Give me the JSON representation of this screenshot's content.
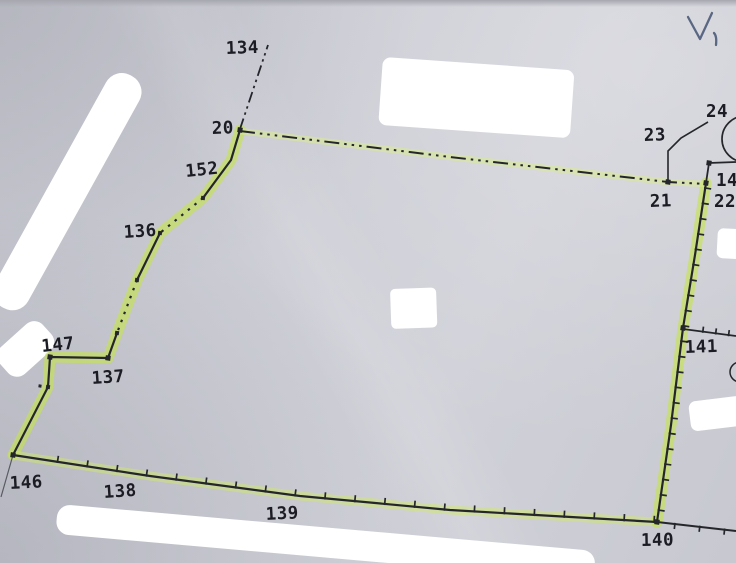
{
  "canvas": {
    "width": 736,
    "height": 563
  },
  "palette": {
    "paper": "#cbccd4",
    "ink": "#24262b",
    "label": "#1b1c24",
    "whiteout": "#ffffff",
    "highlight_bright": "#c7e34c",
    "highlight_pale": "#d9eb90",
    "handwriting_ink": "#5a6783"
  },
  "map": {
    "point_labels": [
      {
        "id": "134",
        "text": "134",
        "x": 226,
        "y": 54,
        "rot": -2
      },
      {
        "id": "20",
        "text": "20",
        "x": 212,
        "y": 134,
        "rot": -2
      },
      {
        "id": "152",
        "text": "152",
        "x": 186,
        "y": 177,
        "rot": -6
      },
      {
        "id": "136",
        "text": "136",
        "x": 124,
        "y": 238,
        "rot": -4
      },
      {
        "id": "147",
        "text": "147",
        "x": 42,
        "y": 352,
        "rot": -6
      },
      {
        "id": "137",
        "text": "137",
        "x": 92,
        "y": 384,
        "rot": -4
      },
      {
        "id": "146",
        "text": "146",
        "x": 10,
        "y": 489,
        "rot": -3
      },
      {
        "id": "138",
        "text": "138",
        "x": 104,
        "y": 498,
        "rot": -4
      },
      {
        "id": "139",
        "text": "139",
        "x": 266,
        "y": 520,
        "rot": -3
      },
      {
        "id": "140",
        "text": "140",
        "x": 641,
        "y": 546,
        "rot": -1
      },
      {
        "id": "141",
        "text": "141",
        "x": 685,
        "y": 353,
        "rot": -2
      },
      {
        "id": "21",
        "text": "21",
        "x": 650,
        "y": 207,
        "rot": -2
      },
      {
        "id": "22",
        "text": "22",
        "x": 714,
        "y": 207,
        "rot": 0
      },
      {
        "id": "23",
        "text": "23",
        "x": 644,
        "y": 141,
        "rot": -2
      },
      {
        "id": "24",
        "text": "24",
        "x": 706,
        "y": 117,
        "rot": 0
      },
      {
        "id": "147-right-clipped",
        "text": "147",
        "x": 716,
        "y": 186,
        "rot": 0
      }
    ],
    "handwriting": {
      "text": "V",
      "color": "#5a6783",
      "paths": [
        "M688,17 L700,39 L712,13",
        "M714,33 q3,3 2,12"
      ]
    },
    "highlights": [
      {
        "name": "highlight-left",
        "pts": [
          [
            240,
            130
          ],
          [
            231,
            160
          ],
          [
            203,
            198
          ],
          [
            160,
            233
          ],
          [
            137,
            280
          ],
          [
            117,
            333
          ],
          [
            108,
            358
          ],
          [
            50,
            357
          ],
          [
            48,
            387
          ],
          [
            13,
            455
          ]
        ],
        "w": 11,
        "color": "#c7e34c",
        "op": 0.62
      },
      {
        "name": "highlight-bottom",
        "pts": [
          [
            13,
            455
          ],
          [
            150,
            476
          ],
          [
            300,
            496
          ],
          [
            450,
            510
          ],
          [
            657,
            522
          ]
        ],
        "w": 9,
        "color": "#cfe76a",
        "op": 0.5
      },
      {
        "name": "highlight-right",
        "pts": [
          [
            657,
            522
          ],
          [
            671,
            425
          ],
          [
            683,
            328
          ],
          [
            695,
            255
          ],
          [
            706,
            183
          ]
        ],
        "w": 11,
        "color": "#c7e34c",
        "op": 0.62
      },
      {
        "name": "highlight-top",
        "pts": [
          [
            240,
            131
          ],
          [
            450,
            157
          ],
          [
            668,
            182
          ],
          [
            706,
            184
          ]
        ],
        "w": 6.5,
        "color": "#d9eb90",
        "op": 0.55
      }
    ],
    "lines": [
      {
        "name": "boundary-top-dashdot",
        "pts": [
          [
            240,
            131
          ],
          [
            450,
            157
          ],
          [
            668,
            182
          ],
          [
            706,
            184
          ]
        ],
        "w": 2,
        "dash": "15 5 2.5 5 2.5 5 2.5 5"
      },
      {
        "name": "boundary-left-solid-1",
        "pts": [
          [
            240,
            130
          ],
          [
            231,
            160
          ],
          [
            203,
            198
          ]
        ],
        "w": 2.2
      },
      {
        "name": "boundary-left-dotted-1",
        "pts": [
          [
            203,
            198
          ],
          [
            160,
            233
          ]
        ],
        "w": 2.2,
        "dash": "2.5 6"
      },
      {
        "name": "boundary-left-solid-2",
        "pts": [
          [
            160,
            233
          ],
          [
            137,
            280
          ]
        ],
        "w": 2.2
      },
      {
        "name": "boundary-left-dotted-2",
        "pts": [
          [
            137,
            280
          ],
          [
            117,
            333
          ]
        ],
        "w": 2.2,
        "dash": "2.5 6"
      },
      {
        "name": "boundary-left-solid-3",
        "pts": [
          [
            117,
            333
          ],
          [
            108,
            358
          ],
          [
            50,
            357
          ],
          [
            48,
            387
          ],
          [
            13,
            455
          ]
        ],
        "w": 2.2
      },
      {
        "name": "boundary-bottom",
        "pts": [
          [
            13,
            455
          ],
          [
            150,
            476
          ],
          [
            300,
            496
          ],
          [
            450,
            510
          ],
          [
            657,
            522
          ]
        ],
        "w": 2.2
      },
      {
        "name": "boundary-bottom-extension",
        "pts": [
          [
            657,
            522
          ],
          [
            736,
            531
          ]
        ],
        "w": 2
      },
      {
        "name": "boundary-right",
        "pts": [
          [
            657,
            522
          ],
          [
            671,
            425
          ],
          [
            683,
            328
          ],
          [
            695,
            255
          ],
          [
            706,
            183
          ]
        ],
        "w": 2.2
      },
      {
        "name": "boundary-topright-corner",
        "pts": [
          [
            706,
            183
          ],
          [
            709,
            163
          ],
          [
            736,
            162
          ]
        ],
        "w": 1.8
      },
      {
        "name": "branch-line-141",
        "pts": [
          [
            683,
            329
          ],
          [
            736,
            336
          ]
        ],
        "w": 1.8
      },
      {
        "name": "leader-line-134",
        "pts": [
          [
            240,
            129
          ],
          [
            268,
            45
          ]
        ],
        "w": 1.8,
        "dash": "11 4 2.5 4 2.5 4"
      },
      {
        "name": "leader-line-23-24",
        "pts": [
          [
            668,
            182
          ],
          [
            668,
            151
          ],
          [
            681,
            138
          ],
          [
            708,
            122
          ]
        ],
        "w": 1.6
      },
      {
        "name": "tail-line-below-146",
        "pts": [
          [
            13,
            455
          ],
          [
            1,
            497
          ]
        ],
        "w": 1.2,
        "color": "#595b63"
      }
    ],
    "tick_runs": [
      {
        "name": "ticks-bottom",
        "pts": [
          [
            13,
            455
          ],
          [
            150,
            476
          ],
          [
            300,
            496
          ],
          [
            450,
            510
          ],
          [
            657,
            522
          ]
        ],
        "spacing": 30,
        "len": 6,
        "side": 1,
        "offset": 45
      },
      {
        "name": "ticks-bottom-extension",
        "pts": [
          [
            657,
            522
          ],
          [
            736,
            531
          ]
        ],
        "spacing": 25,
        "len": 5,
        "side": -1,
        "offset": 18
      },
      {
        "name": "ticks-right",
        "pts": [
          [
            657,
            522
          ],
          [
            671,
            425
          ],
          [
            683,
            328
          ],
          [
            695,
            255
          ],
          [
            706,
            183
          ]
        ],
        "spacing": 15.5,
        "len": 6,
        "side": -1,
        "offset": 12
      },
      {
        "name": "ticks-branch-141",
        "pts": [
          [
            683,
            329
          ],
          [
            736,
            336
          ]
        ],
        "spacing": 13,
        "len": 5,
        "side": 1,
        "offset": 20
      }
    ],
    "vertex_dots": [
      [
        240,
        130,
        5
      ],
      [
        203,
        198,
        4
      ],
      [
        160,
        233,
        4
      ],
      [
        137,
        280,
        4
      ],
      [
        117,
        333,
        4
      ],
      [
        108,
        358,
        5
      ],
      [
        50,
        357,
        5
      ],
      [
        48,
        387,
        4
      ],
      [
        40,
        386,
        3
      ],
      [
        13,
        455,
        5
      ],
      [
        657,
        522,
        5
      ],
      [
        683,
        328,
        5
      ],
      [
        706,
        183,
        5
      ],
      [
        709,
        163,
        5
      ],
      [
        668,
        182,
        5
      ]
    ],
    "circles": [
      {
        "name": "edge-circle-top-right",
        "cx": 745,
        "cy": 139,
        "r": 23,
        "w": 1.7
      },
      {
        "name": "edge-circle-mid-right",
        "cx": 740,
        "cy": 372,
        "r": 10,
        "w": 1.5
      }
    ],
    "blobs": [
      {
        "name": "whiteout-top-center",
        "x": 383,
        "y": 57,
        "w": 192,
        "h": 68,
        "rot": 4,
        "rx": 8
      },
      {
        "name": "whiteout-left-diagonal",
        "x": 148,
        "y": 85,
        "w": 265,
        "h": 38,
        "rot": 119,
        "rx": 18
      },
      {
        "name": "whiteout-left-edge",
        "x": -8,
        "y": 355,
        "w": 58,
        "h": 36,
        "rot": -42,
        "rx": 12
      },
      {
        "name": "whiteout-mid",
        "x": 390,
        "y": 289,
        "w": 46,
        "h": 40,
        "rot": -2,
        "rx": 5
      },
      {
        "name": "whiteout-right-upper",
        "x": 718,
        "y": 228,
        "w": 26,
        "h": 30,
        "rot": 3,
        "rx": 6
      },
      {
        "name": "whiteout-right-lower",
        "x": 688,
        "y": 402,
        "w": 54,
        "h": 30,
        "rot": -7,
        "rx": 7
      },
      {
        "name": "whiteout-bottom-strip",
        "x": 58,
        "y": 504,
        "w": 540,
        "h": 30,
        "rot": 5,
        "rx": 13
      }
    ]
  }
}
